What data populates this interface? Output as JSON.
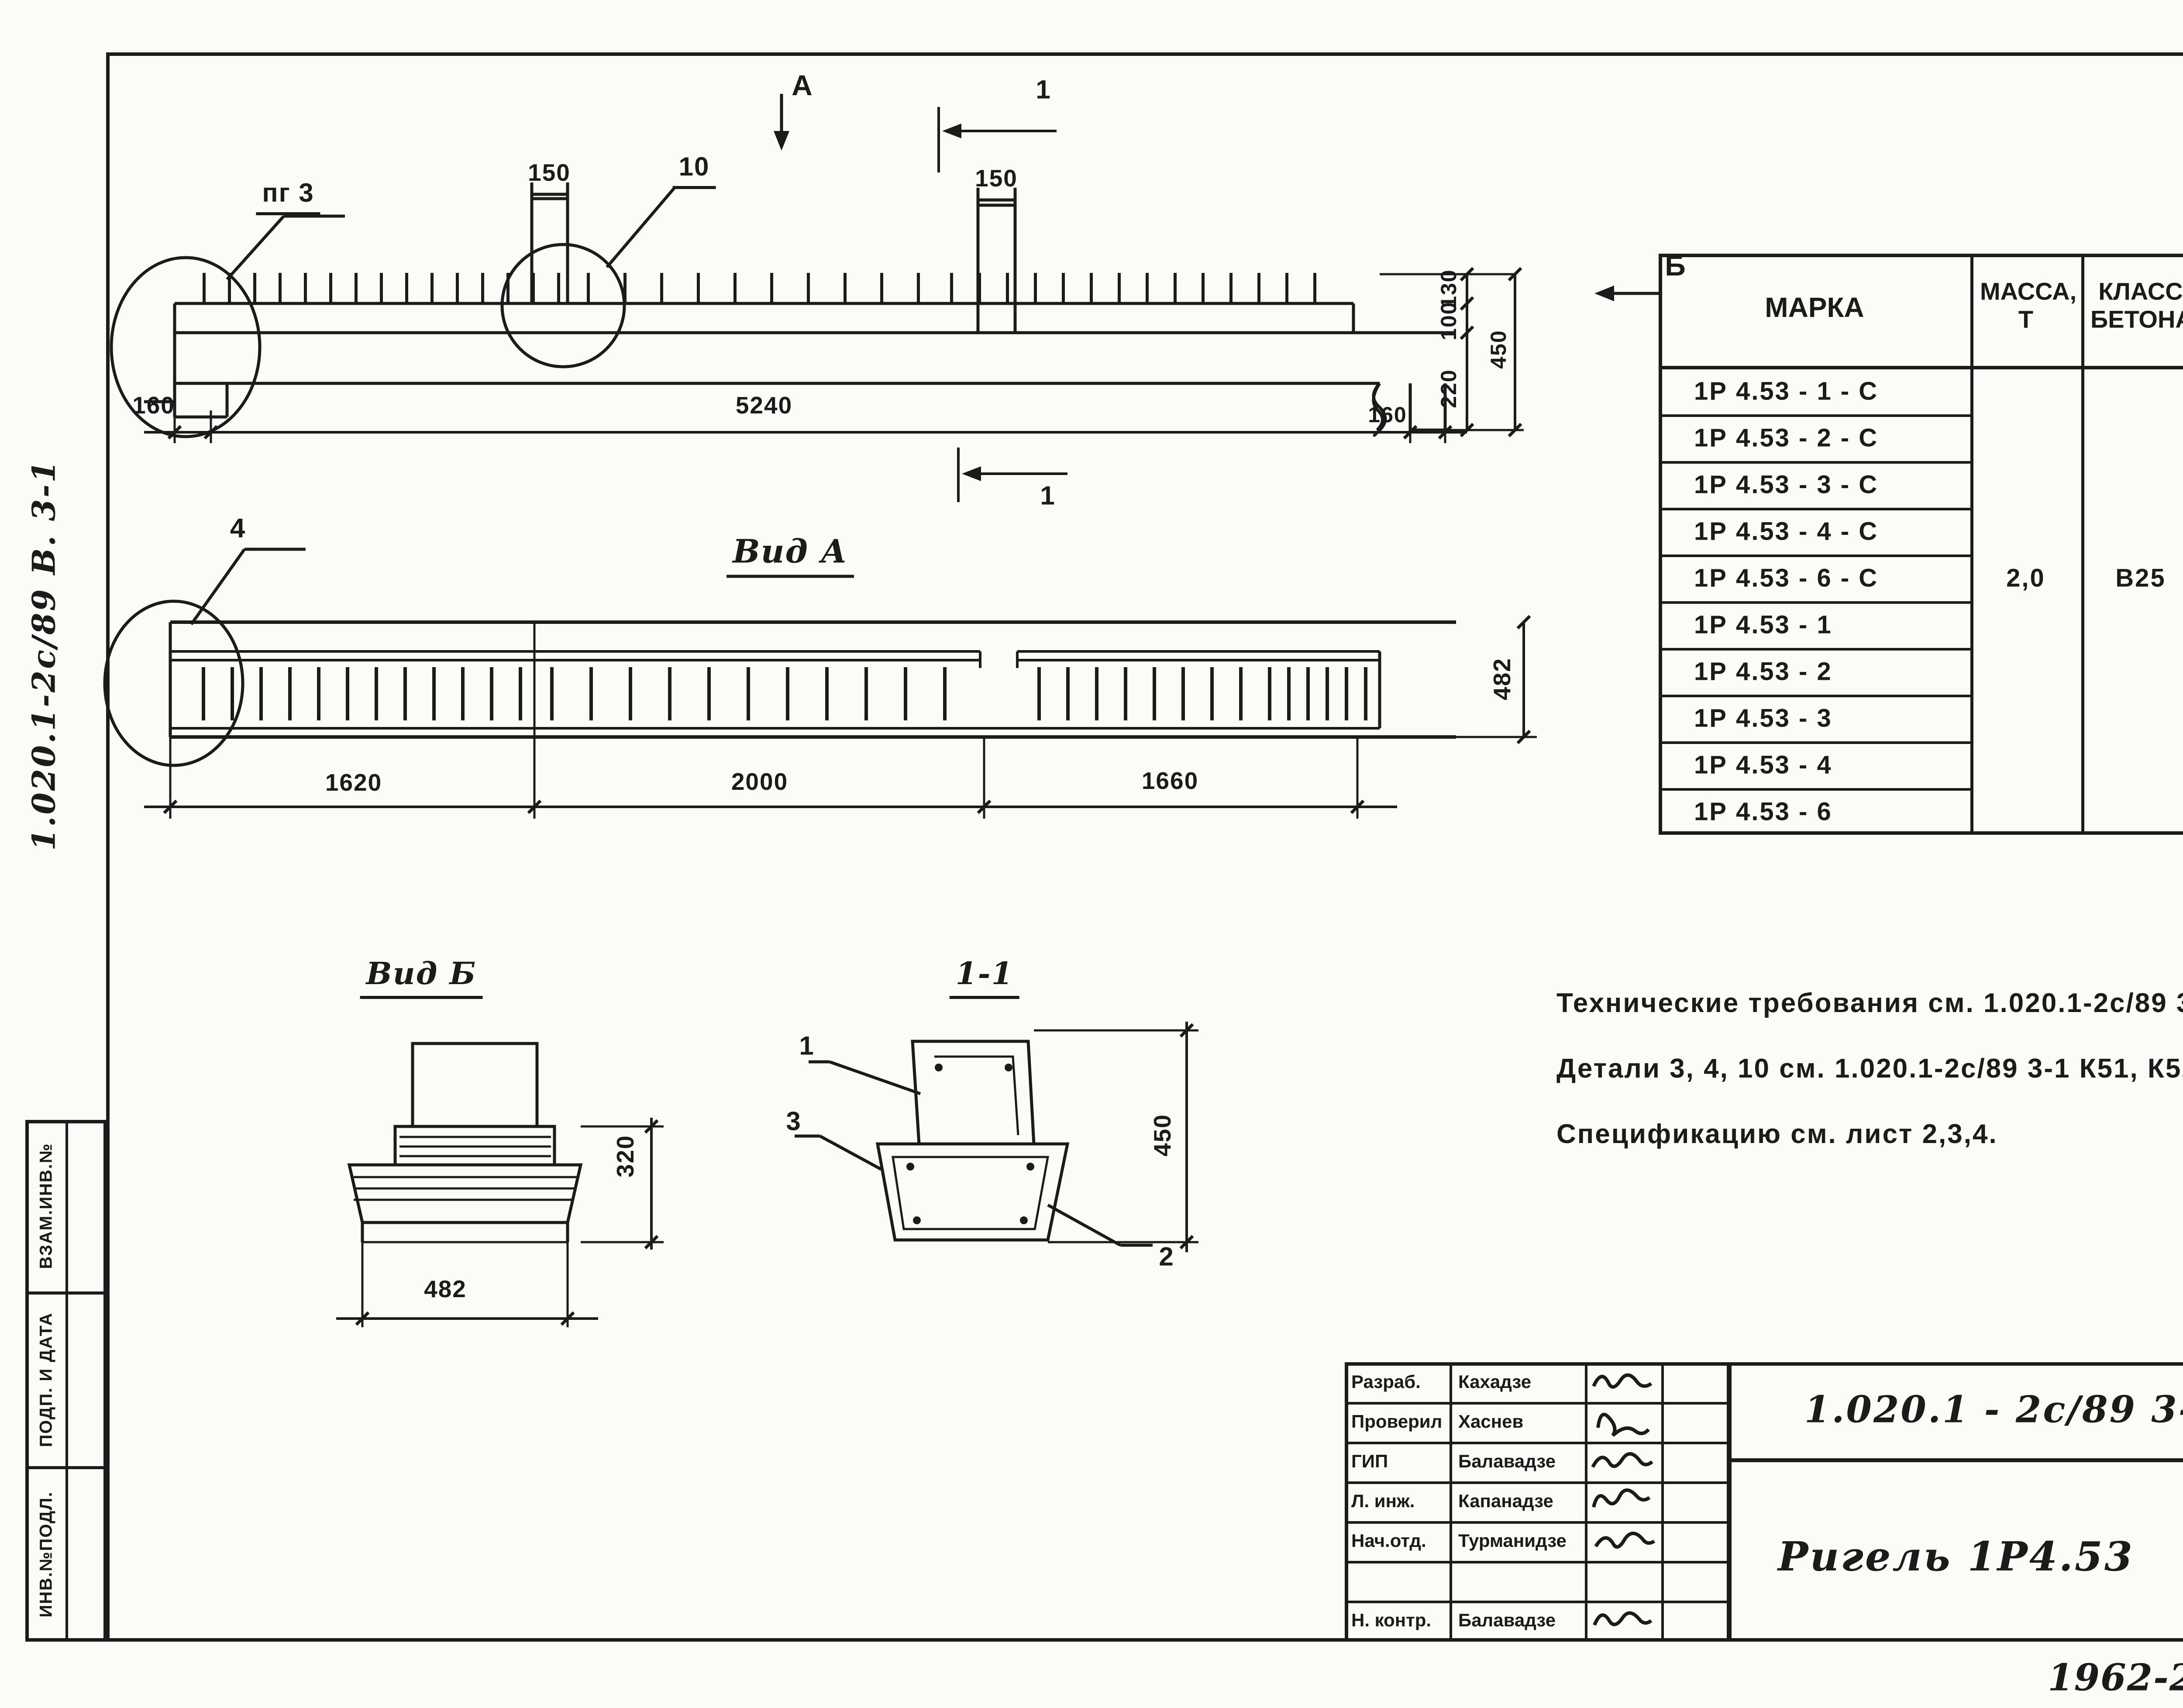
{
  "page": {
    "sheet_number": "20",
    "format_label": "ФОРМАТ А3",
    "handwritten_job": "1962-29",
    "handwritten_sheet": "21"
  },
  "margin": {
    "doc_ref_vertical": "1.020.1-2с/89 В. 3-1",
    "stamp_boxes": [
      {
        "label": "ВЗАМ.ИНВ.№"
      },
      {
        "label": "ПОДП. И ДАТА"
      },
      {
        "label": "ИНВ.№ПОДЛ."
      }
    ]
  },
  "elevation": {
    "detail_ref": "пг 3",
    "detail_no": "10",
    "dim_stub_left": "150",
    "dim_stub_right": "150",
    "section_mark_a": "А",
    "section_mark_1_top": "1",
    "section_mark_1_bottom": "1",
    "view_mark_b": "Б",
    "dim_left_overhang": "160",
    "dim_length": "5240",
    "dim_right_overhang": "160",
    "dim_v_130": "130",
    "dim_v_100": "100",
    "dim_v_220": "220",
    "dim_v_total": "450"
  },
  "view_a": {
    "title": "Вид А",
    "detail_ref": "4",
    "dim_seg1": "1620",
    "dim_seg2": "2000",
    "dim_seg3": "1660",
    "dim_height": "482"
  },
  "view_b": {
    "title": "Вид Б",
    "dim_height": "320",
    "dim_width": "482"
  },
  "section_1_1": {
    "title": "1-1",
    "callout_top": "1",
    "callout_left": "3",
    "callout_bottom": "2",
    "dim_height": "450"
  },
  "notes": {
    "line1": "Технические требования см. 1.020.1-2с/89 3-1-ТТ.",
    "line2": "Детали 3, 4, 10  см. 1.020.1-2с/89 3-1 К51, К52, К58.",
    "line3": "Спецификацию см. лист 2,3,4."
  },
  "spec_table": {
    "headers": {
      "mark": "МАРКА",
      "mass": "МАССА, Т",
      "concrete_class": "КЛАСС БЕТОНА",
      "concrete_volume": "ОБЪЕМ БЕТОНА, М³",
      "steel": "РАСХОД СТАЛИ, КГ"
    },
    "shared": {
      "mass": "2,0",
      "concrete_class": "В25",
      "concrete_volume": "0,78"
    },
    "rows": [
      {
        "mark": "1Р 4.53 - 1 - С",
        "steel": "116,7"
      },
      {
        "mark": "1Р 4.53 - 2 - С",
        "steel": "132,0"
      },
      {
        "mark": "1Р 4.53 - 3 - С",
        "steel": "143,0"
      },
      {
        "mark": "1Р 4.53 - 4 - С",
        "steel": "159,4"
      },
      {
        "mark": "1Р 4.53 - 6 - С",
        "steel": "190,8"
      },
      {
        "mark": "1Р 4.53 - 1",
        "steel": "110,0"
      },
      {
        "mark": "1Р 4.53 - 2",
        "steel": "125,3"
      },
      {
        "mark": "1Р 4.53 - 3",
        "steel": "136,3"
      },
      {
        "mark": "1Р 4.53 - 4",
        "steel": "152,8"
      },
      {
        "mark": "1Р 4.53 - 6",
        "steel": "184,4"
      }
    ]
  },
  "title_block": {
    "doc_number": "1.020.1 - 2с/89 3-1 К7",
    "product_title": "Ригель  1Р4.53",
    "organization": "ТбилЗНИИЭП",
    "stage_header": "Стадия",
    "sheet_header": "Лист",
    "sheets_header": "Листов",
    "stage": "Р",
    "sheet": "1",
    "sheets": "4",
    "roles": [
      {
        "role": "Разраб.",
        "name": "Кахадзе"
      },
      {
        "role": "Проверил",
        "name": "Хаснев"
      },
      {
        "role": "ГИП",
        "name": "Балавадзе"
      },
      {
        "role": "Л. инж.",
        "name": "Капанадзе"
      },
      {
        "role": "Нач.отд.",
        "name": "Турманидзе"
      },
      {
        "role": "",
        "name": ""
      },
      {
        "role": "Н. контр.",
        "name": "Балавадзе"
      }
    ]
  }
}
